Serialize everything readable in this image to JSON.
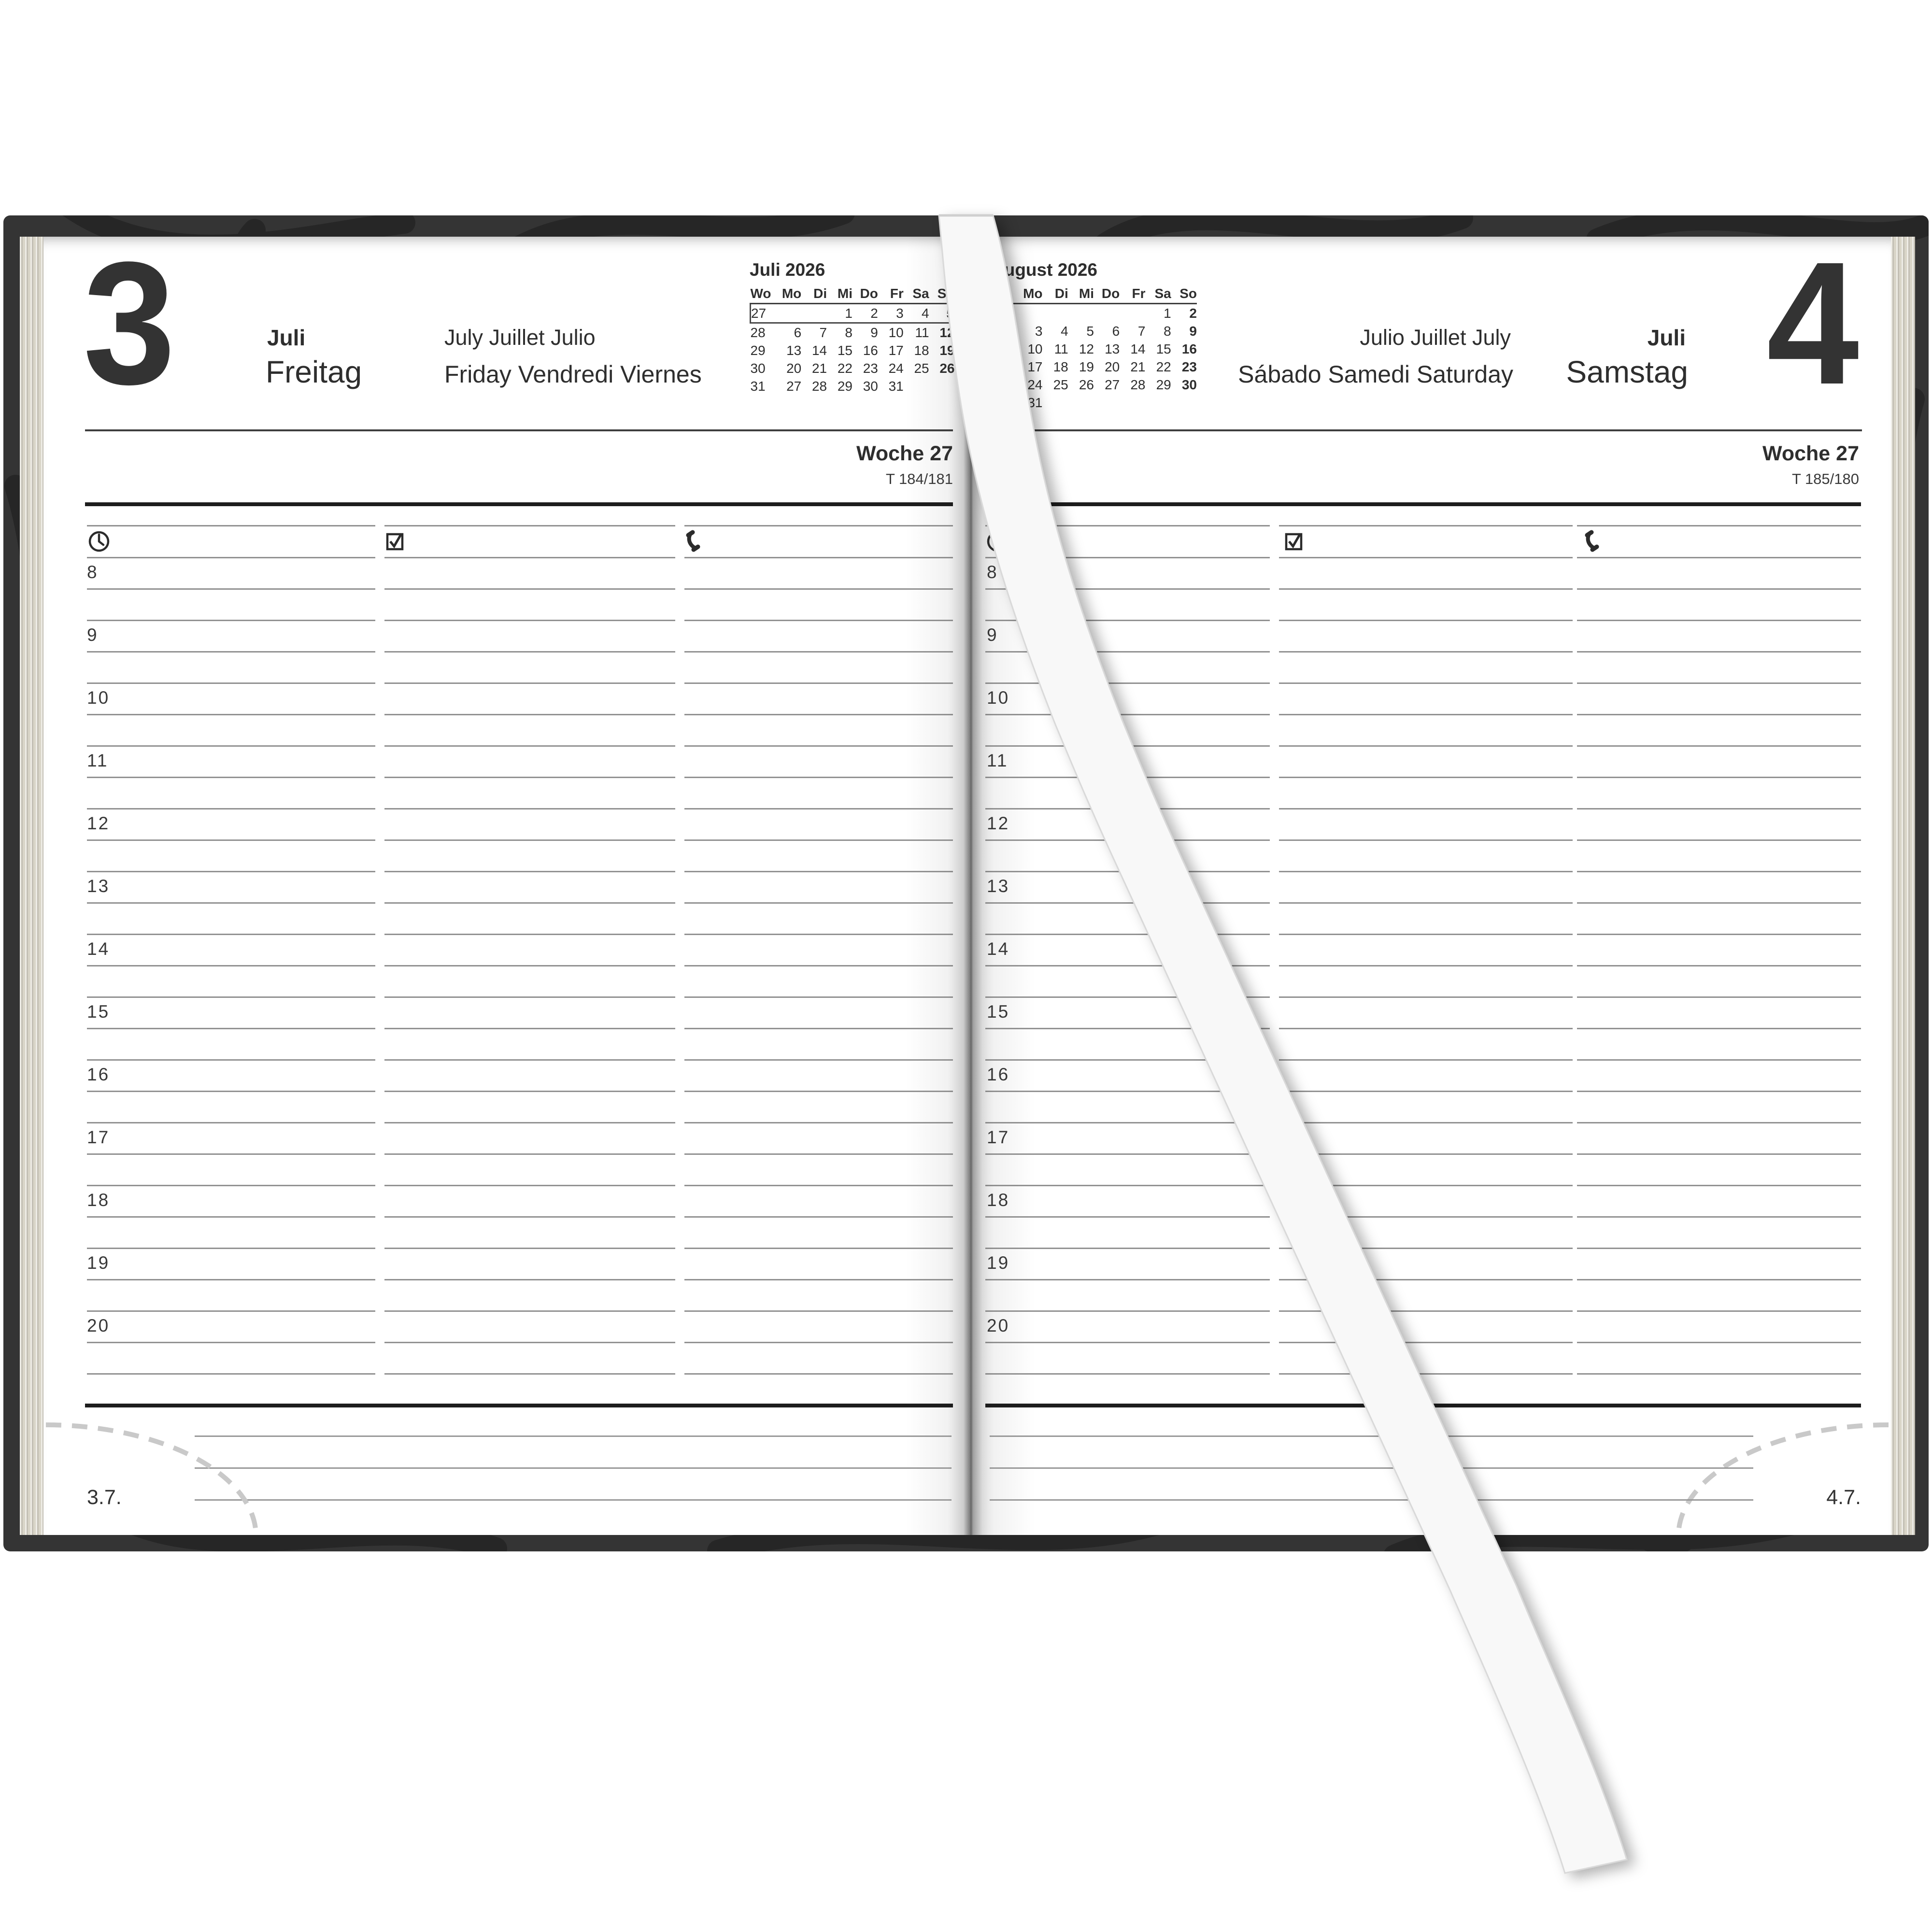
{
  "book": {
    "left_page": {
      "day_number": "3",
      "month": "Juli",
      "weekday": "Freitag",
      "month_translations": "July Juillet Julio",
      "weekday_translations": "Friday Vendredi Viernes",
      "week_label": "Woche 27",
      "day_of_year": "T 184/181",
      "footer_date": "3.7."
    },
    "right_page": {
      "day_number": "4",
      "month": "Juli",
      "weekday": "Samstag",
      "month_translations": "Julio Juillet July",
      "weekday_translations": "Sábado Samedi Saturday",
      "week_label": "Woche 27",
      "day_of_year": "T 185/180",
      "footer_date": "4.7.",
      "holiday_marker": "US"
    },
    "hours": [
      "8",
      "9",
      "10",
      "11",
      "12",
      "13",
      "14",
      "15",
      "16",
      "17",
      "18",
      "19",
      "20"
    ],
    "column_icons": [
      "clock-icon",
      "checkbox-icon",
      "phone-icon"
    ],
    "mini_calendar_left": {
      "title": "Juli 2026",
      "weekday_header": [
        "Wo",
        "Mo",
        "Di",
        "Mi",
        "Do",
        "Fr",
        "Sa",
        "So"
      ],
      "boxed_week_row": 0,
      "rows": [
        {
          "week": "27",
          "days": [
            "",
            "",
            "1",
            "2",
            "3",
            "4",
            "5"
          ]
        },
        {
          "week": "28",
          "days": [
            "6",
            "7",
            "8",
            "9",
            "10",
            "11",
            "12"
          ]
        },
        {
          "week": "29",
          "days": [
            "13",
            "14",
            "15",
            "16",
            "17",
            "18",
            "19"
          ]
        },
        {
          "week": "30",
          "days": [
            "20",
            "21",
            "22",
            "23",
            "24",
            "25",
            "26"
          ]
        },
        {
          "week": "31",
          "days": [
            "27",
            "28",
            "29",
            "30",
            "31",
            "",
            ""
          ]
        }
      ]
    },
    "mini_calendar_right": {
      "title": "August 2026",
      "weekday_header": [
        "Wo",
        "Mo",
        "Di",
        "Mi",
        "Do",
        "Fr",
        "Sa",
        "So"
      ],
      "boxed_week_row": null,
      "rows": [
        {
          "week": "31",
          "days": [
            "",
            "",
            "",
            "",
            "",
            "1",
            "2"
          ]
        },
        {
          "week": "32",
          "days": [
            "3",
            "4",
            "5",
            "6",
            "7",
            "8",
            "9"
          ]
        },
        {
          "week": "33",
          "days": [
            "10",
            "11",
            "12",
            "13",
            "14",
            "15",
            "16"
          ]
        },
        {
          "week": "34",
          "days": [
            "17",
            "18",
            "19",
            "20",
            "21",
            "22",
            "23"
          ]
        },
        {
          "week": "35",
          "days": [
            "24",
            "25",
            "26",
            "27",
            "28",
            "29",
            "30"
          ]
        },
        {
          "week": "36",
          "days": [
            "31",
            "",
            "",
            "",
            "",
            "",
            ""
          ]
        }
      ]
    },
    "colors": {
      "cover": "#343434",
      "page": "#fdfdfd",
      "page_edge": "#d9d5c8",
      "ribbon": "#f8f8f8",
      "grid_line": "#7f7f7f",
      "thick_line": "#1d1d1d"
    }
  }
}
